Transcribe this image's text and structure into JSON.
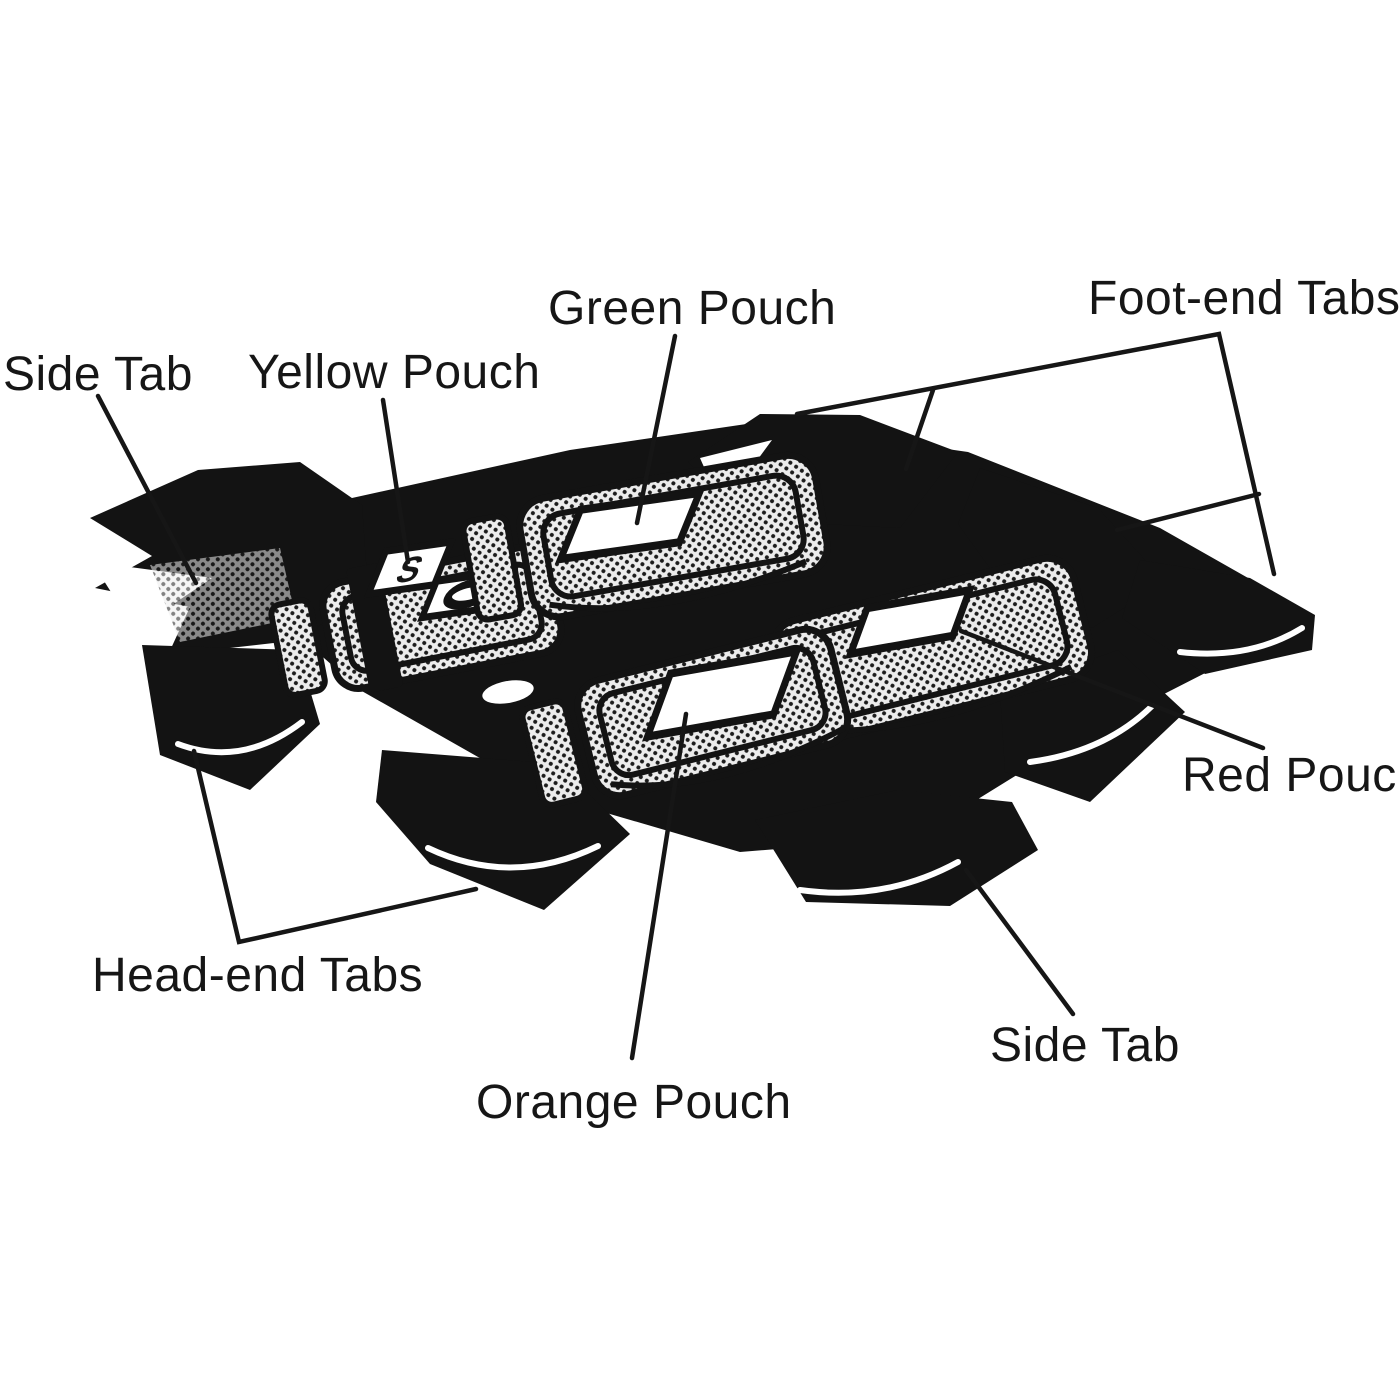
{
  "figure": {
    "background_color": "#ffffff",
    "ink_color": "#141414",
    "description": "Monochrome isometric drawing of an unfolded carrier mat with fold-over tabs and four color-coded pouches",
    "labels": {
      "side_tab_top": "Side Tab",
      "yellow_pouch": "Yellow Pouch",
      "green_pouch": "Green Pouch",
      "foot_end_tabs": "Foot-end Tabs",
      "red_pouch": "Red Pouch",
      "head_end_tabs": "Head-end Tabs",
      "side_tab_bottom": "Side Tab",
      "orange_pouch": "Orange Pouch"
    },
    "yellow_pouch_snap_glyph": "S"
  }
}
